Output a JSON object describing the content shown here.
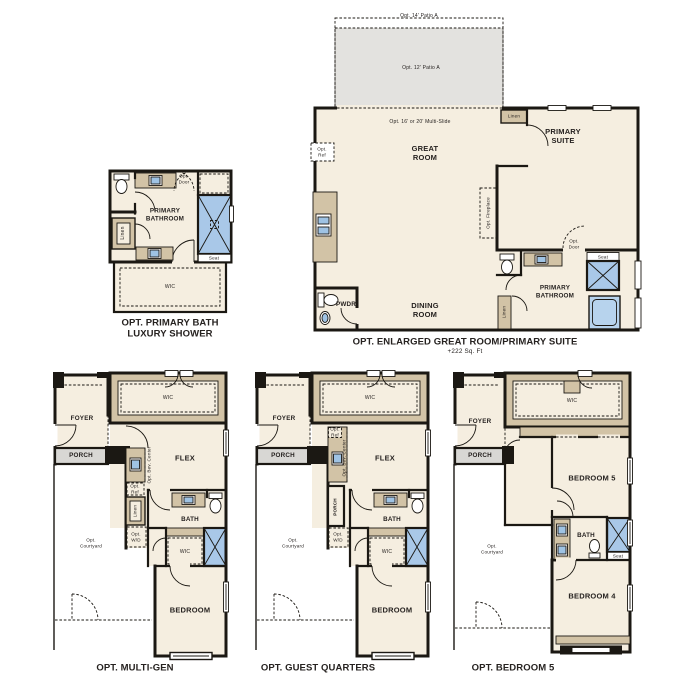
{
  "colors": {
    "floor": "#f5eee0",
    "wall": "#1b1813",
    "cabinet": "#d2c3a6",
    "shower": "#a9c8e8",
    "tub": "#b7d3ed",
    "patio": "#e3e2df",
    "porch": "#d8d7d4",
    "sink": "#9fc3e4"
  },
  "plans": {
    "primary_bath": {
      "caption": "OPT. PRIMARY BATH\nLUXURY SHOWER",
      "labels": {
        "room": "PRIMARY\nBATHROOM",
        "wic": "WIC",
        "linen": "Linen",
        "seat": "Seat",
        "opt_door": "Opt.\nDoor"
      }
    },
    "great_room": {
      "caption": "OPT. ENLARGED GREAT ROOM/PRIMARY SUITE",
      "subcaption": "+222 Sq. Ft",
      "labels": {
        "patio14": "Opt. 14' Patio A",
        "patio12": "Opt. 12' Patio A",
        "multi_slide": "Opt. 16' or 20' Multi-Slide",
        "opt_ref": "Opt.\nRef",
        "great_room": "GREAT\nROOM",
        "primary_suite": "PRIMARY\nSUITE",
        "linen_top": "Linen",
        "fireplace": "Opt. Fireplace",
        "pwdr": "PWDR",
        "dining_room": "DINING\nROOM",
        "primary_bathroom": "PRIMARY\nBATHROOM",
        "linen_bath": "Linen",
        "opt_door": "Opt.\nDoor",
        "seat": "Seat"
      }
    },
    "multi_gen": {
      "caption": "OPT. MULTI-GEN",
      "labels": {
        "foyer": "FOYER",
        "porch": "PORCH",
        "wic_top": "WIC",
        "flex": "FLEX",
        "bev_center": "Opt. Bev. Center",
        "opt_ref": "Opt.\nRef",
        "linen": "Linen",
        "opt_wd": "Opt.\nW/D",
        "bath": "BATH",
        "wic": "WIC",
        "bedroom": "BEDROOM",
        "courtyard": "Opt.\nCourtyard"
      }
    },
    "guest_quarters": {
      "caption": "OPT. GUEST QUARTERS",
      "labels": {
        "foyer": "FOYER",
        "porch": "PORCH",
        "wic_top": "WIC",
        "flex": "FLEX",
        "opt_ref": "Opt.\nRef",
        "bev_center": "Opt. Bev. Center",
        "porch_side": "PORCH",
        "opt_wd": "Opt.\nW/D",
        "bath": "BATH",
        "wic": "WIC",
        "bedroom": "BEDROOM",
        "courtyard": "Opt.\nCourtyard"
      }
    },
    "bedroom5": {
      "caption": "OPT. BEDROOM 5",
      "labels": {
        "foyer": "FOYER",
        "porch": "PORCH",
        "wic": "WIC",
        "bedroom5": "BEDROOM 5",
        "bath": "BATH",
        "seat": "Seat",
        "bedroom4": "BEDROOM 4",
        "courtyard": "Opt.\nCourtyard"
      }
    }
  }
}
